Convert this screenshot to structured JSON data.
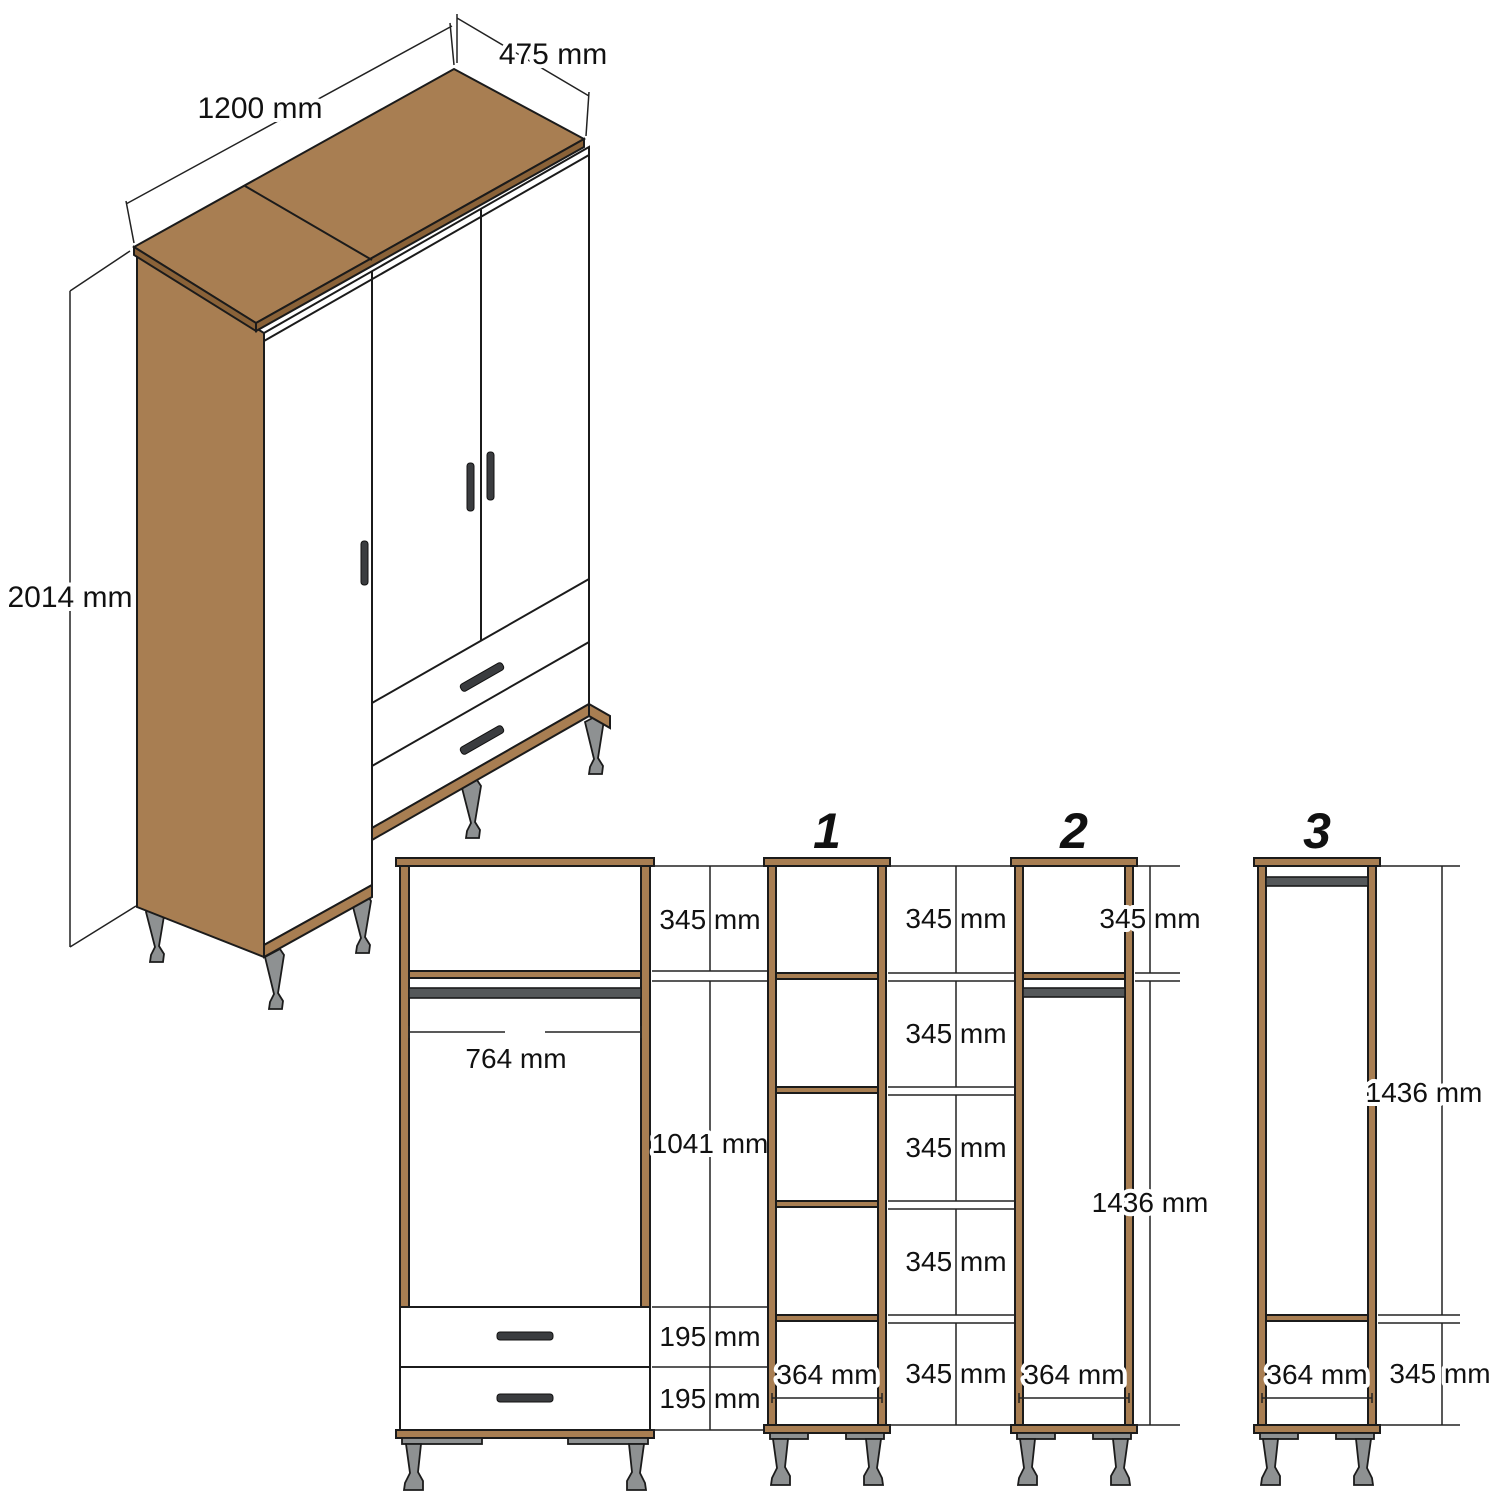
{
  "drawing": {
    "type": "wardrobe-technical-drawing",
    "iso": {
      "width_label": "1200 mm",
      "depth_label": "475 mm",
      "height_label": "2014 mm"
    },
    "front_view": {
      "top_section": "345 mm",
      "rail_width": "764 mm",
      "middle_section": "1041 mm",
      "drawer_top": "195 mm",
      "drawer_bottom": "195 mm"
    },
    "sections": [
      {
        "num": "1",
        "dims": [
          "345 mm",
          "345 mm",
          "345 mm",
          "345 mm",
          "345 mm"
        ],
        "width": "364 mm"
      },
      {
        "num": "2",
        "dims": [
          "345 mm",
          "1436 mm"
        ],
        "width": "364 mm"
      },
      {
        "num": "3",
        "dims": [
          "1436 mm",
          "345 mm"
        ],
        "width": "364 mm"
      }
    ]
  },
  "colors": {
    "wood": "#A87E52",
    "wood_edge": "#8A6238",
    "metal": "#8E9192",
    "rail": "#55585A",
    "handle": "#3A3C3F",
    "outline": "#1B1B1B"
  }
}
